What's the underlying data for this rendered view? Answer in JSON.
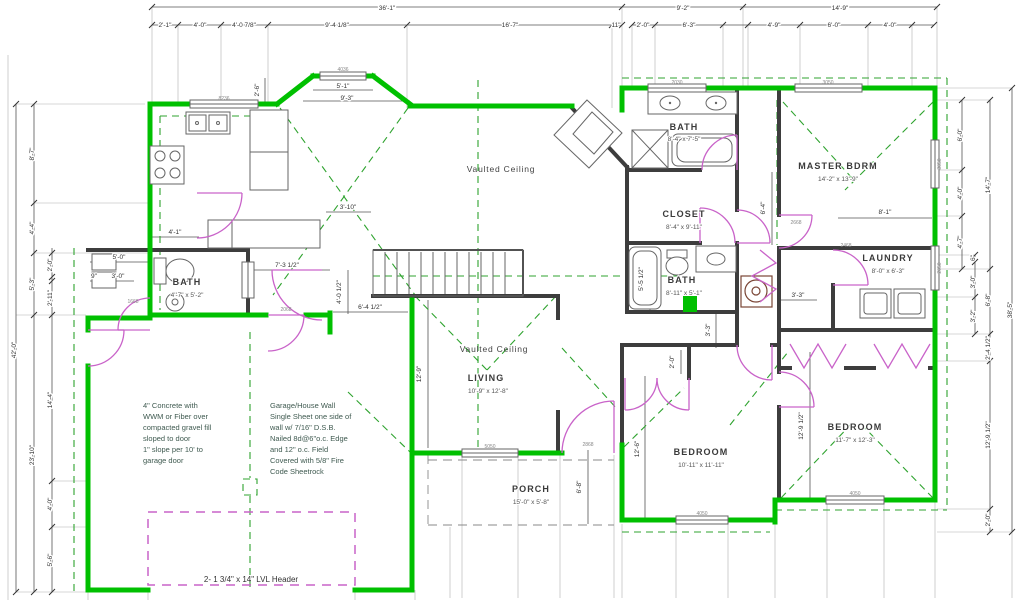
{
  "colors": {
    "wall_exterior": "#00c000",
    "wall_interior": "#3d3d3d",
    "door_swing": "#c963c9",
    "roof_dashed_line": "#2fa32f",
    "dimension_text": "#333333",
    "note_text": "#3f5a50"
  },
  "dims": {
    "top1": [
      "36'-1\"",
      "9'-2\"",
      "14'-9\""
    ],
    "top2": [
      "2'-1\"",
      "4'-0\"",
      "4'-0 7/8\"",
      "9'-4 1/8\"",
      "16'-7\"",
      "11\"",
      "2'-0\"",
      "6'-3\"",
      "4'-9\"",
      "6'-0\"",
      "4'-0\""
    ],
    "left": [
      "8'-7\"",
      "4'-4\"",
      "5'-3\"",
      "2'-0\"",
      "2'-11\"",
      "42'-0\"",
      "23'-10\"",
      "14'-4\"",
      "4'-0\"",
      "5'-6\""
    ],
    "right": [
      "6'-0\"",
      "4'-0\"",
      "4'-7\"",
      "6\"",
      "3'-0\"",
      "3'-2\"",
      "14'-7\"",
      "6'-8\"",
      "38'-5\"",
      "2'-4 1/2\"",
      "12'-9 1/2\"",
      "2'-0\""
    ],
    "inner": [
      "5'-1\"",
      "9'-3\"",
      "2'-6\"",
      "3'-10\"",
      "4'-1\"",
      "5'-0\"",
      "9\"",
      "3'-0\"",
      "7'-3 1/2\"",
      "4'-0 1/2\"",
      "6'-4 1/2\"",
      "12'-9\"",
      "6'-4\"",
      "8'-1\"",
      "5'-5 1/2\"",
      "3'-3\"",
      "3'-3\"",
      "2'-0\"",
      "12'-6\"",
      "12'-9 1/2\"",
      "6'-8\""
    ]
  },
  "rooms": [
    {
      "name": "BATH",
      "size": "8'-4\" x 7'-5\""
    },
    {
      "name": "MASTER BDRM",
      "size": "14'-2\" x 13'-9\""
    },
    {
      "name": "CLOSET",
      "size": "8'-4\" x 9'-11\""
    },
    {
      "name": "LAUNDRY",
      "size": "8'-0\" x 6'-3\""
    },
    {
      "name": "BATH",
      "size": "8'-11\" x 5'-1\""
    },
    {
      "name": "BATH",
      "size": "4'-7\" x 5'-2\""
    },
    {
      "name": "LIVING",
      "size": "10'-9\" x 12'-8\""
    },
    {
      "name": "BEDROOM",
      "size": "10'-11\" x 11'-11\""
    },
    {
      "name": "BEDROOM",
      "size": "11'-7\" x 12'-3\""
    },
    {
      "name": "PORCH",
      "size": "15'-0\" x 5'-8\""
    }
  ],
  "ceilings": [
    "Vaulted Ceiling",
    "Vaulted Ceiling"
  ],
  "notes": {
    "concrete": [
      "4\" Concrete with",
      "WWM or Fiber over",
      "compacted gravel fill",
      "sloped to door",
      "1\" slope per 10' to",
      "garage door"
    ],
    "garage_wall": [
      "Garage/House Wall",
      "Single Sheet one side of",
      "wall w/ 7/16\" D.S.B.",
      "Nailed 8d@6\"o.c. Edge",
      "and 12\" o.c. Field",
      "Covered with 5/8\" Fire",
      "Code Sheetrock"
    ]
  },
  "header_note": "2- 1 3/4\" x 14\" LVL Header",
  "window_tags": [
    "8236",
    "4036",
    "2030",
    "3050",
    "3050",
    "2050",
    "5050",
    "4050",
    "4050",
    "2868",
    "2068",
    "2668",
    "2468",
    "1668"
  ]
}
